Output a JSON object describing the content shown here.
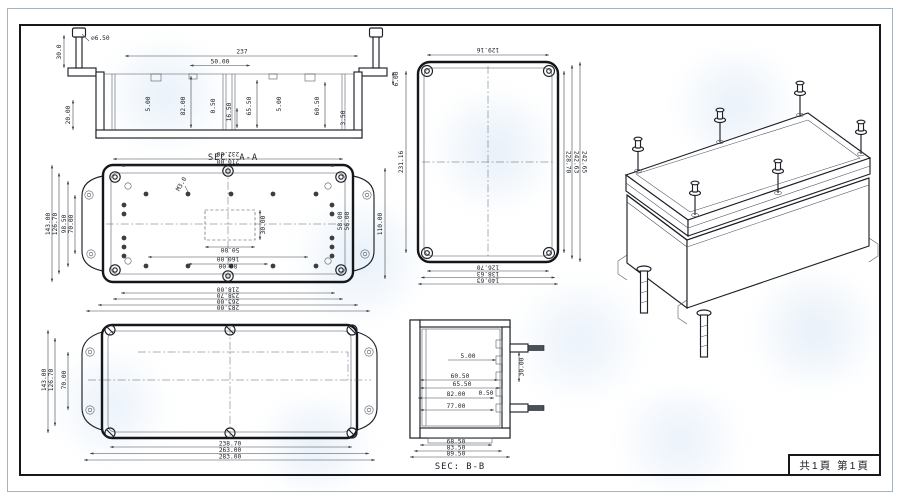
{
  "page": {
    "label": "共1頁 第1頁"
  },
  "sec_aa": {
    "title": "SEC: A-A",
    "dia": "⌀6.50",
    "d30": "30.0",
    "d237": "237",
    "d50": "50.00",
    "d5a": "5.00",
    "d82": "82.00",
    "d05": "0.50",
    "d165": "16.50",
    "d655": "65.50",
    "d5b": "5.00",
    "d605": "60.50",
    "d35": "3.50",
    "d20": "20.00",
    "d6": "6.00"
  },
  "plan": {
    "top": [
      "232.00",
      "210.00"
    ],
    "bottom": [
      "218.00",
      "238.70",
      "263.00",
      "283.00"
    ],
    "left": [
      "143.00",
      "126.70",
      "98.50",
      "70.00"
    ],
    "right": "110.00",
    "cw": "50.00",
    "ch": "30.00",
    "d160": "160.00",
    "d80": "80.00",
    "d58": "58.00",
    "d56": "56.00",
    "thread": "M3.0"
  },
  "lid": {
    "left": [
      "143.00",
      "126.70",
      "70.00"
    ],
    "bottom": [
      "238.70",
      "263.00",
      "283.00"
    ]
  },
  "end": {
    "top": "129.16",
    "left": "231.16",
    "right": [
      "228.70",
      "242.63",
      "242.65"
    ],
    "bottom": [
      "126.70",
      "138.63",
      "140.63"
    ]
  },
  "sec_bb": {
    "title": "SEC: B-B",
    "d5": "5.00",
    "d605": "60.50",
    "d655": "65.50",
    "d82": "82.00",
    "d05": "0.50",
    "d77": "77.00",
    "d30": "30.00",
    "bottom": [
      "68.50",
      "83.50",
      "89.50"
    ]
  }
}
